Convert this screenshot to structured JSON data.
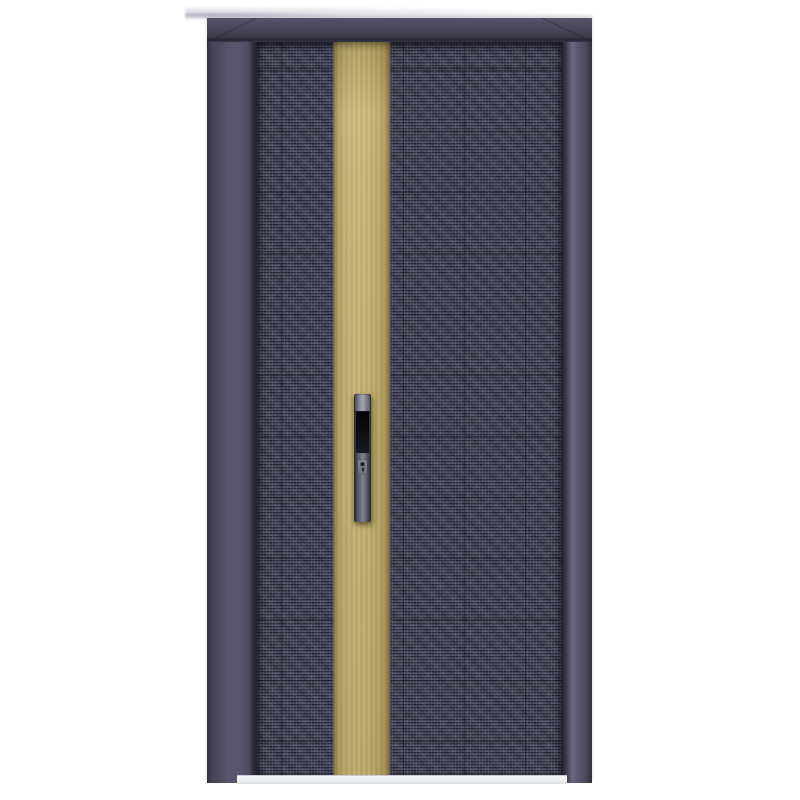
{
  "scene": {
    "type": "product-photo",
    "subject": "Modern security entry door: dark slate frame, woven dark-navy textured panel, vertical brass inlay stripe, vertical pull handle with grip recess and keyhole, light threshold sill",
    "text_content": "none"
  },
  "door": {
    "colors": {
      "bg": "#ffffff",
      "frame-outer": "#34323f",
      "frame-face": "#56536b",
      "frame-head": "#49475b",
      "frame-seam": "#232230",
      "leaf-base": "#414155",
      "leaf-light": "#7e7e94",
      "leaf-dark": "#0c0c16",
      "stripe": "#c9b576",
      "stripe-light": "#ccb87a",
      "stripe-dark": "#6e6244",
      "handle-body": "#71717d",
      "handle-light": "#a5a5af",
      "handle-dark": "#26262f",
      "handle-recess": "#0e0e13",
      "sill": "#eef0f2"
    },
    "parts": [
      "door-frame",
      "door-leaf-panel",
      "decorative-brass-stripe",
      "door-handle",
      "handle-grip-recess",
      "keyhole",
      "door-sill"
    ]
  }
}
